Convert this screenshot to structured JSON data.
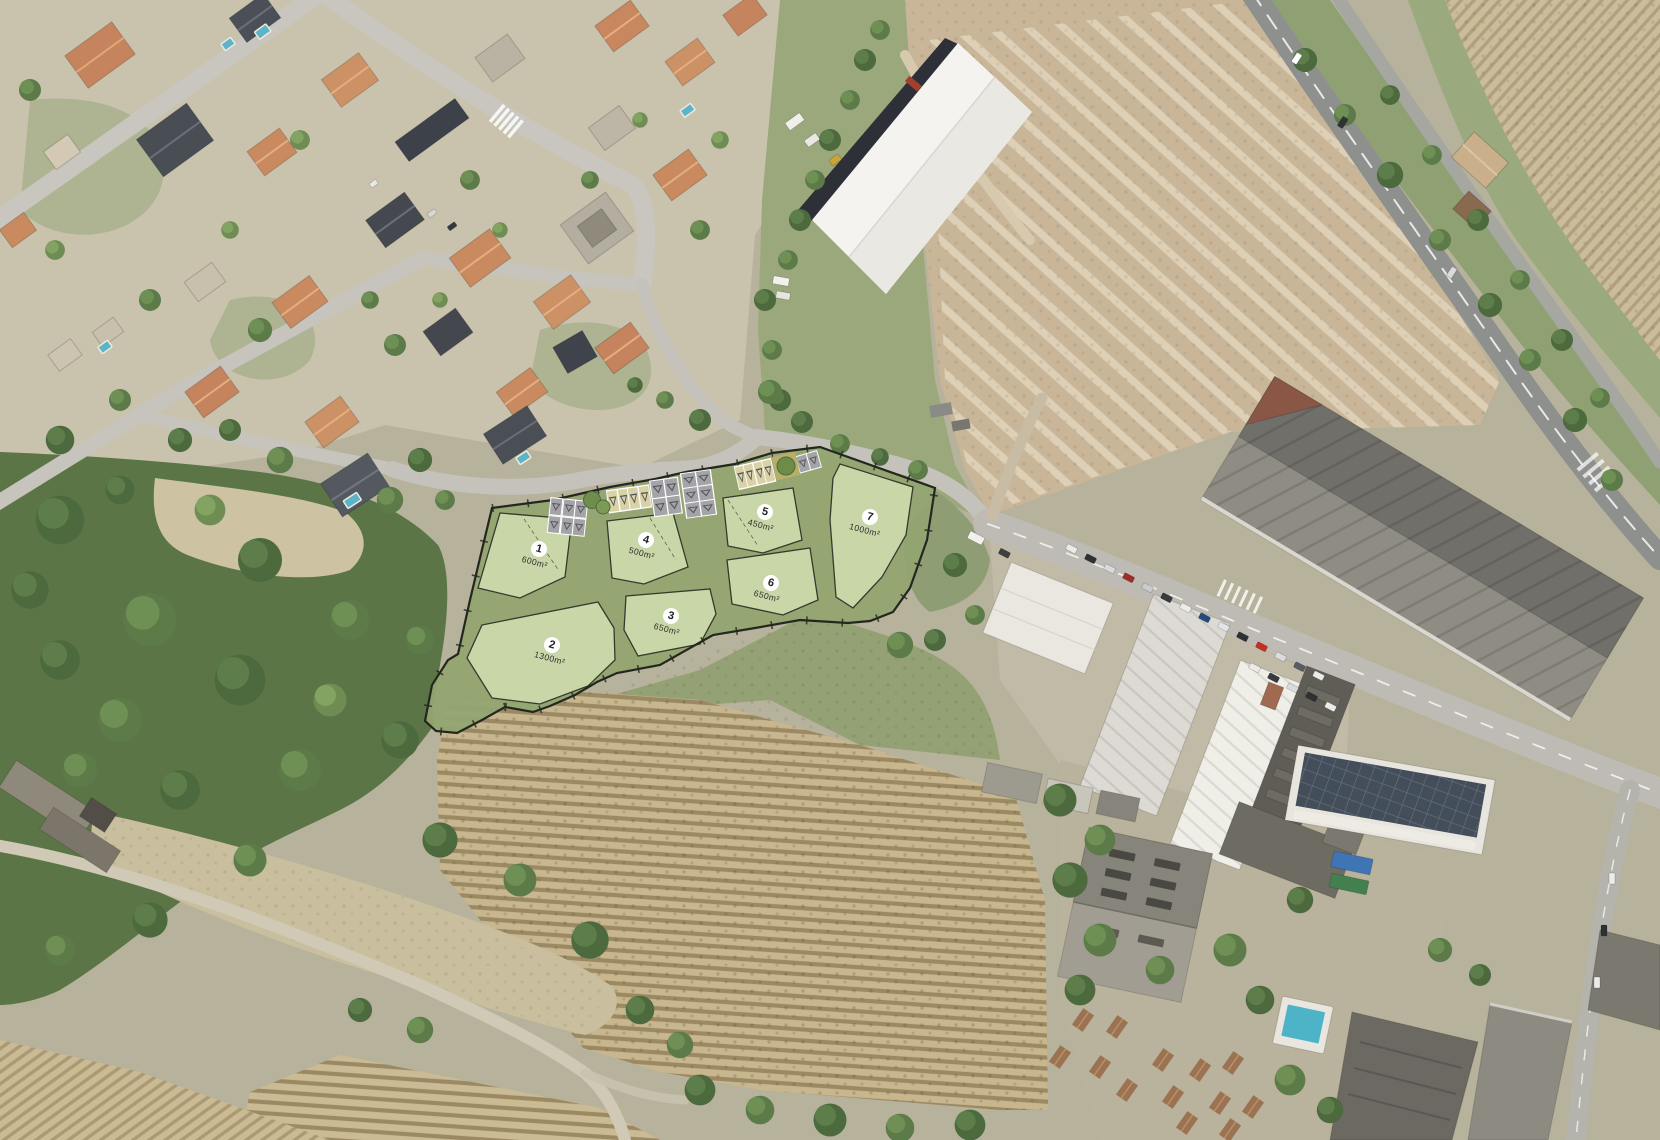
{
  "overlay": {
    "plots": [
      {
        "number": "1",
        "area": "600m²"
      },
      {
        "number": "2",
        "area": "1300m²"
      },
      {
        "number": "3",
        "area": "650m²"
      },
      {
        "number": "4",
        "area": "500m²"
      },
      {
        "number": "5",
        "area": "450m²"
      },
      {
        "number": "6",
        "area": "650m²"
      },
      {
        "number": "7",
        "area": "1000m²"
      }
    ],
    "colors": {
      "common_area_green": "#92a571",
      "plot_green": "#c9d6a7",
      "boundary": "#23271f",
      "parking_gray": "#a4a4a8",
      "parking_beige": "#d9d2a6",
      "plot_marker_circle": "#ffffff",
      "label_text": "#2f2f2f"
    }
  }
}
